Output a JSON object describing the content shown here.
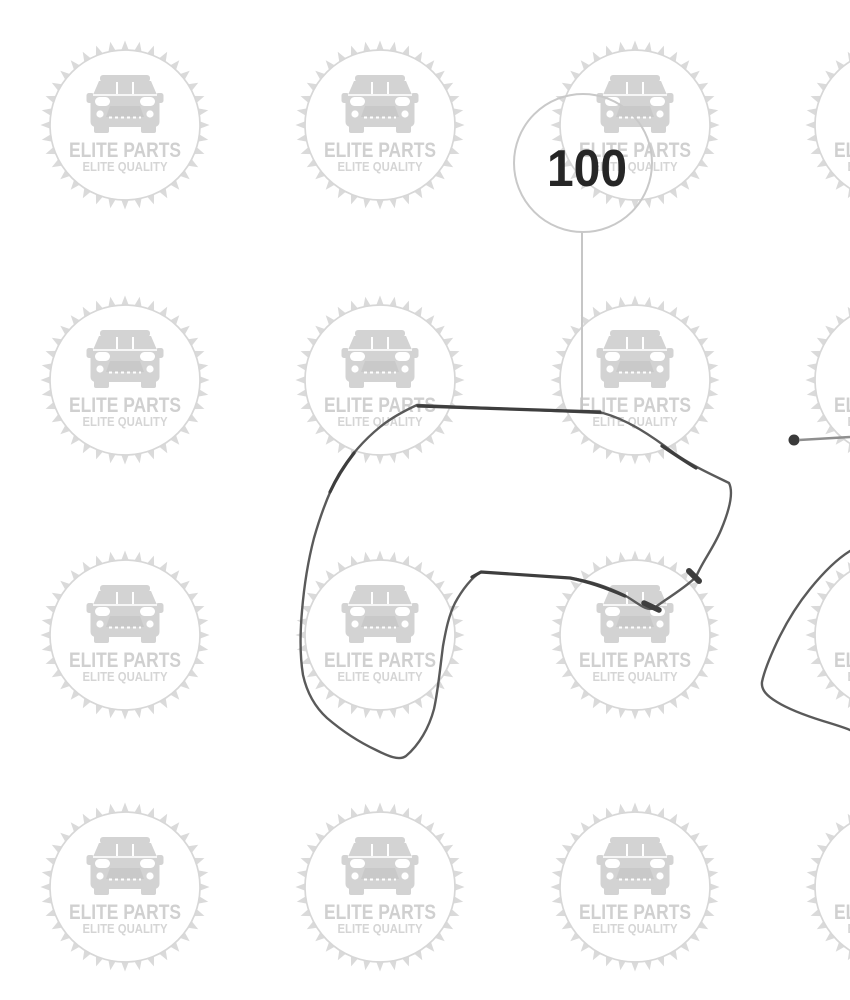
{
  "watermark": {
    "title": "ELITE PARTS",
    "subtitle": "ELITE QUALITY",
    "icon": "car-front-icon",
    "color": "#d8d8d8"
  },
  "callout": {
    "label": "100"
  },
  "colors": {
    "background": "#ffffff",
    "part_line": "#5a5a5a",
    "part_line_dark": "#3e3e3e",
    "callout_text": "#262626",
    "callout_circle": "#c9c9c9",
    "leader_line": "#c6c6c6",
    "fastener_dot": "#3a3a3a",
    "fastener_line": "#8f8f8f",
    "watermark": "#d8d8d8"
  }
}
